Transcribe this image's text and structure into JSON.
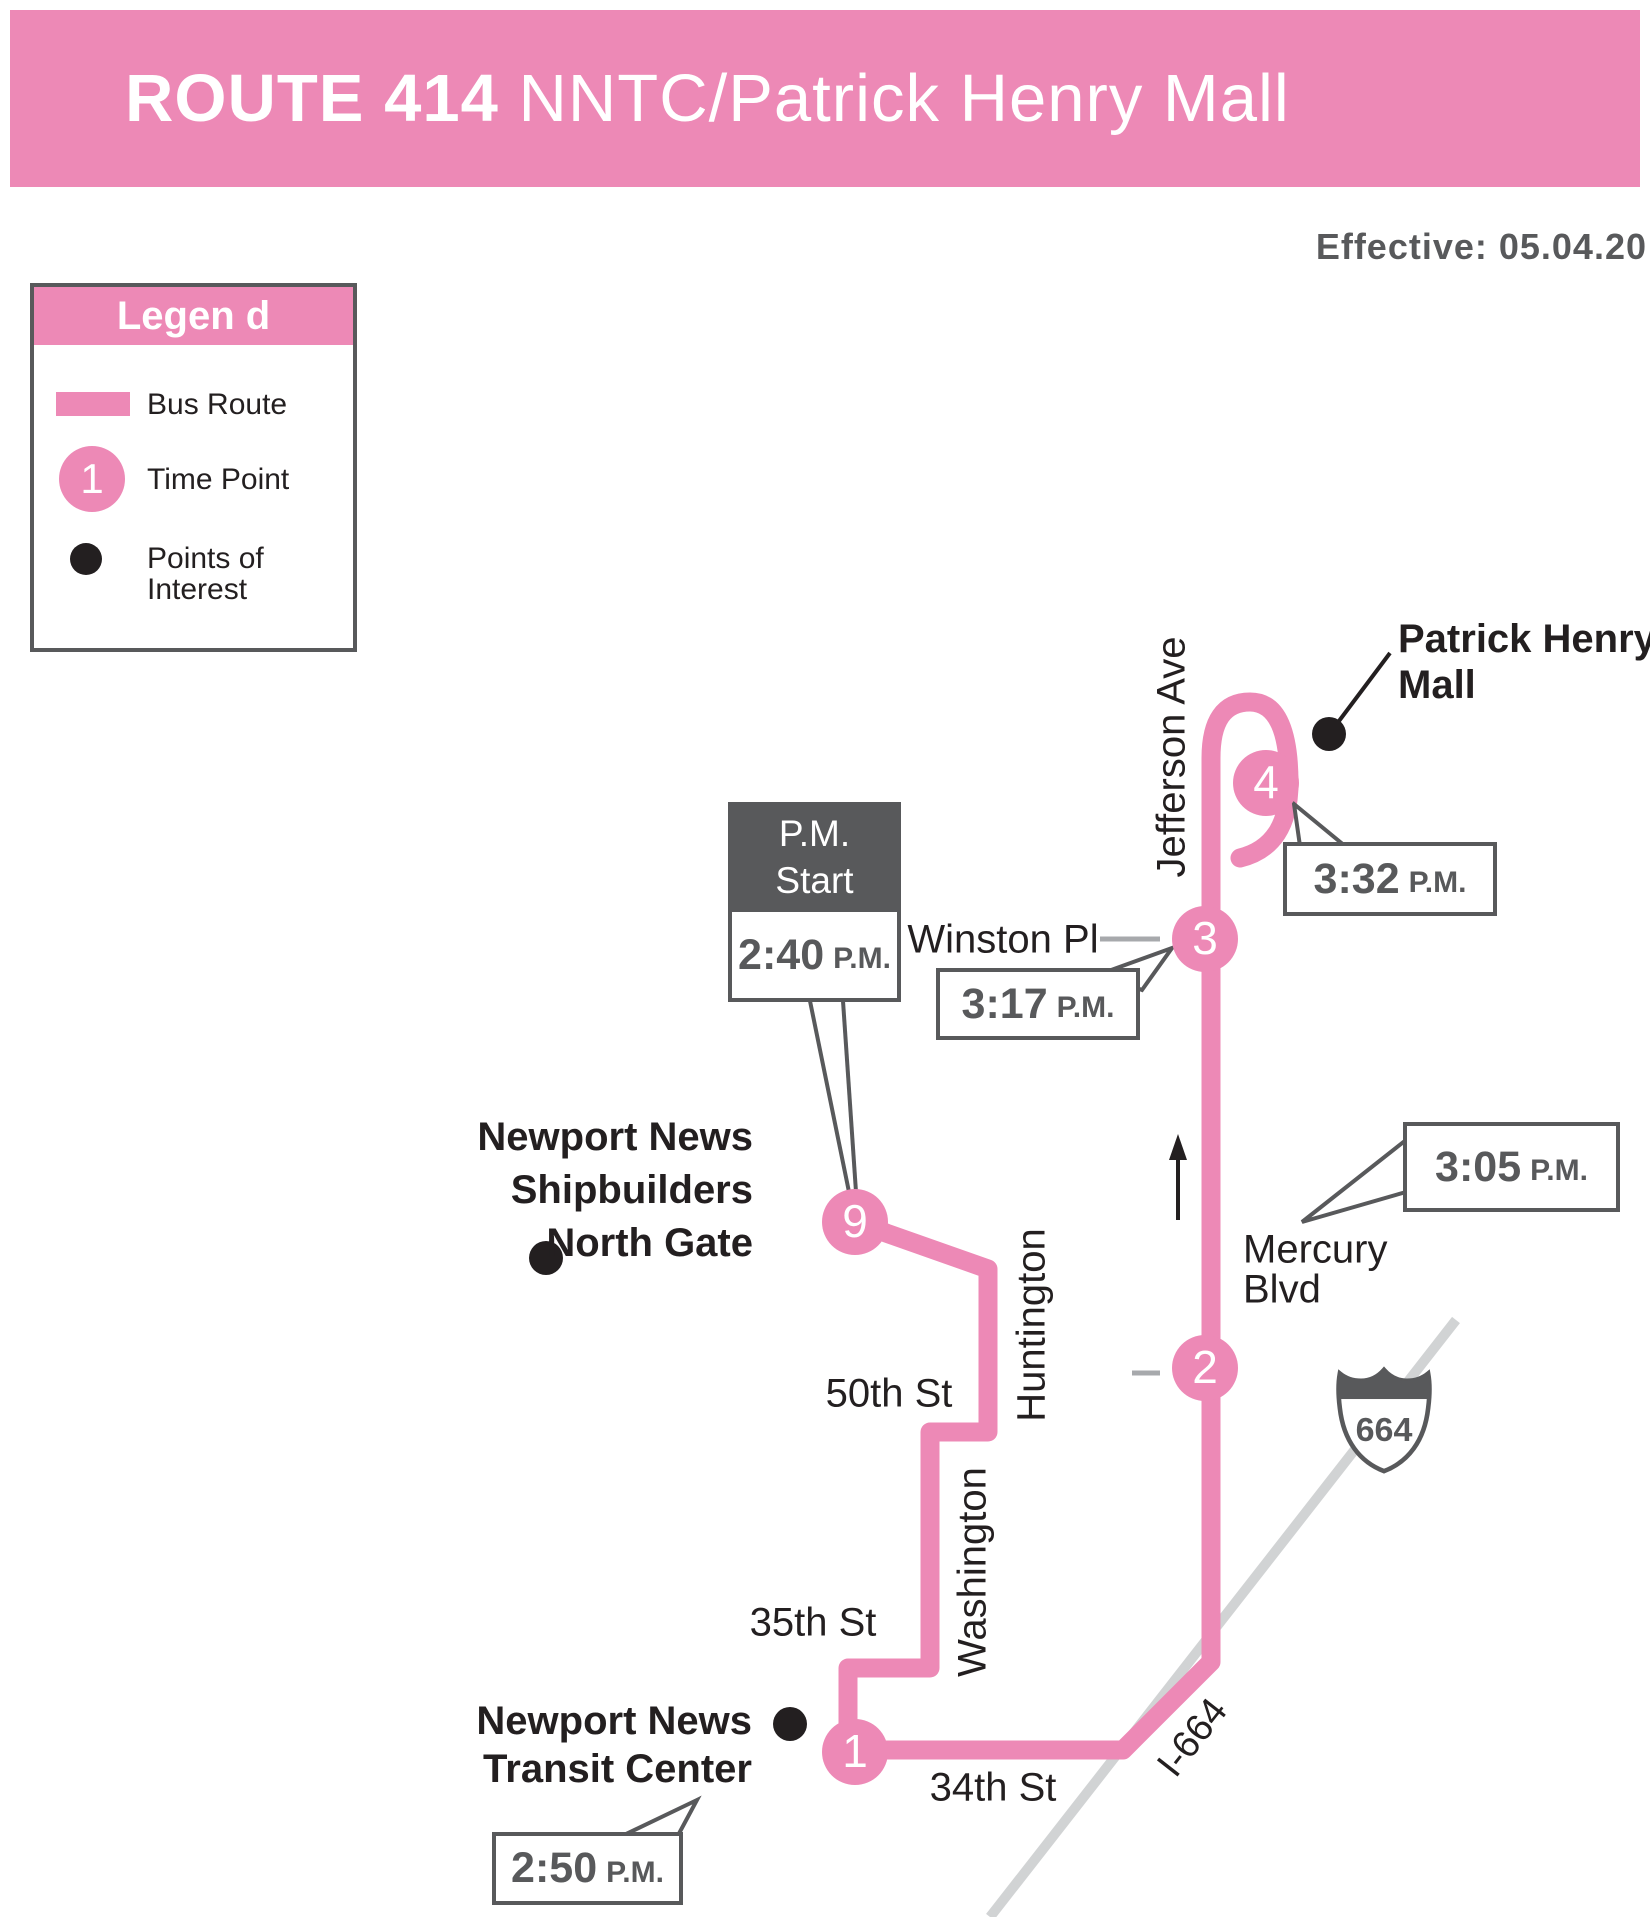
{
  "colors": {
    "pink": "#ED89B6",
    "dark_gray": "#58595B",
    "text_black": "#231F20",
    "road_gray": "#D1D3D4",
    "dash_gray": "#A7A9AC",
    "white": "#FFFFFF"
  },
  "header": {
    "title_bold": "ROUTE 414",
    "title_rest": " NNTC/Patrick Henry Mall",
    "effective": "Effective: 05.04.20"
  },
  "legend": {
    "title": "Legen d",
    "bus_route": "Bus Route",
    "time_point": "Time Point",
    "time_point_symbol": "1",
    "poi_line1": "Points of",
    "poi_line2": "Interest"
  },
  "map": {
    "streets": {
      "jefferson": "Jefferson Ave",
      "huntington": "Huntington",
      "washington": "Washington",
      "winston": "Winston Pl",
      "fiftieth": "50th St",
      "thirty_fifth": "35th St",
      "thirty_fourth": "34th St",
      "mercury_line1": "Mercury",
      "mercury_line2": "Blvd",
      "i664": "I-664",
      "shield_number": "664"
    },
    "pois": {
      "patrick_line1": "Patrick Henry",
      "patrick_line2": "Mall",
      "ship_line1": "Newport News",
      "ship_line2": "Shipbuilders",
      "ship_line3": "North Gate",
      "transit_line1": "Newport News",
      "transit_line2": "Transit Center"
    },
    "timepoints": {
      "tp1": "1",
      "tp2": "2",
      "tp3": "3",
      "tp4": "4",
      "tp9": "9"
    },
    "callouts": {
      "pm_start_line1": "P.M.",
      "pm_start_line2": "Start",
      "t_start": {
        "time": "2:40",
        "suffix": "P.M."
      },
      "t_mall": {
        "time": "3:32",
        "suffix": "P.M."
      },
      "t_winston": {
        "time": "3:17",
        "suffix": "P.M."
      },
      "t_mercury": {
        "time": "3:05",
        "suffix": "P.M."
      },
      "t_transit": {
        "time": "2:50",
        "suffix": "P.M."
      }
    }
  }
}
